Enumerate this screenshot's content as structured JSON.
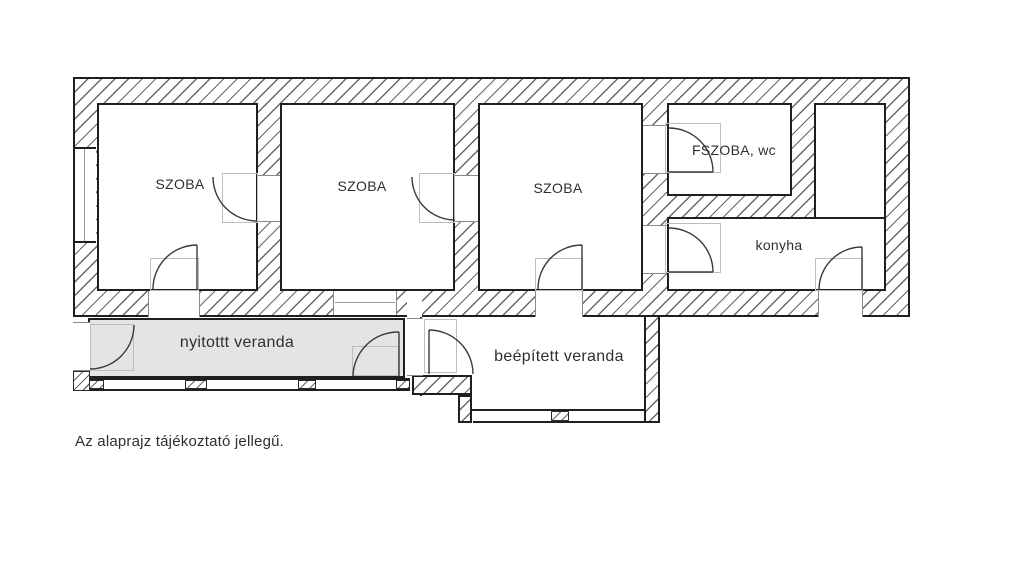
{
  "palette": {
    "background": "#ffffff",
    "wall_line": "#1f1f1f",
    "hatch_line": "#686868",
    "open_veranda_fill": "#e4e4e4",
    "door_guide": "#bdbdbd",
    "text": "#2f2f2f"
  },
  "labels": {
    "szoba1": "SZOBA",
    "szoba2": "SZOBA",
    "szoba3": "SZOBA",
    "fszoba": "FSZOBA, wc",
    "konyha": "konyha",
    "nyitott_veranda": "nyitottt veranda",
    "beepitett_veranda": "beépített veranda",
    "note": "Az alaprajz tájékoztató jellegű."
  }
}
